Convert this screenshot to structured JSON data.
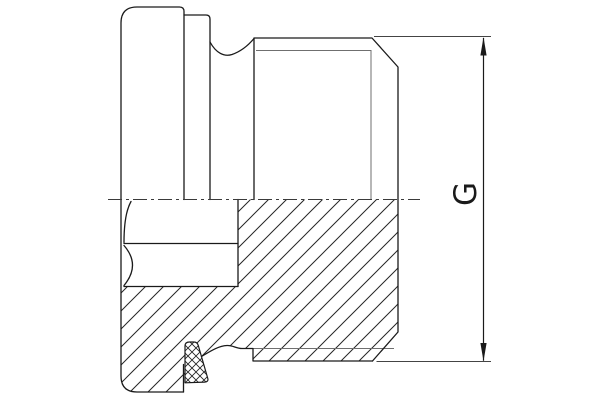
{
  "drawing": {
    "dimension_label": "G"
  },
  "style": {
    "background": "#ffffff",
    "line_color": "#1a1a1a",
    "thin_line_color": "#6f6f6f",
    "hatch_color": "#262626"
  }
}
